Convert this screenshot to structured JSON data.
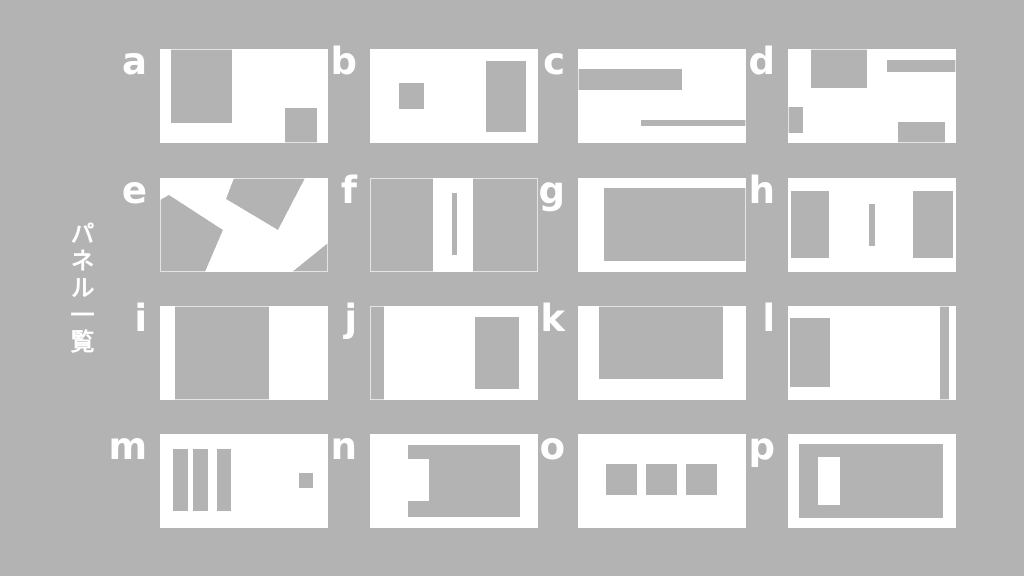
{
  "title": {
    "vertical_label": "パネル一覧"
  },
  "colors": {
    "background": "#b3b3b3",
    "panel": "#ffffff",
    "shape": "#b3b3b3",
    "label_text": "#ffffff"
  },
  "grid": {
    "rows": 4,
    "cols": 4,
    "col_x": [
      160,
      370,
      578,
      788
    ],
    "row_y": [
      49,
      178,
      306,
      434
    ],
    "panel_w": 168,
    "panel_h": 94
  },
  "panels": [
    {
      "label": "a",
      "col": 0,
      "row": 0,
      "shapes": [
        {
          "type": "rect",
          "x": 11,
          "y": 0,
          "w": 61,
          "h": 74
        },
        {
          "type": "rect",
          "x": 125,
          "y": 59,
          "w": 32,
          "h": 35
        }
      ]
    },
    {
      "label": "b",
      "col": 1,
      "row": 0,
      "shapes": [
        {
          "type": "rect",
          "x": 29,
          "y": 34,
          "w": 25,
          "h": 26
        },
        {
          "type": "rect",
          "x": 116,
          "y": 12,
          "w": 40,
          "h": 71
        }
      ]
    },
    {
      "label": "c",
      "col": 2,
      "row": 0,
      "shapes": [
        {
          "type": "rect",
          "x": 0,
          "y": 20,
          "w": 104,
          "h": 21
        },
        {
          "type": "rect",
          "x": 63,
          "y": 71,
          "w": 105,
          "h": 6
        }
      ]
    },
    {
      "label": "d",
      "col": 3,
      "row": 0,
      "shapes": [
        {
          "type": "rect",
          "x": 23,
          "y": 0,
          "w": 56,
          "h": 39
        },
        {
          "type": "rect",
          "x": 99,
          "y": 11,
          "w": 69,
          "h": 12
        },
        {
          "type": "rect",
          "x": 0,
          "y": 58,
          "w": 15,
          "h": 26
        },
        {
          "type": "rect",
          "x": 110,
          "y": 73,
          "w": 47,
          "h": 21
        }
      ]
    },
    {
      "label": "e",
      "col": 0,
      "row": 1,
      "shapes": [
        {
          "type": "polygon",
          "points": [
            [
              74,
              0
            ],
            [
              145,
              0
            ],
            [
              118,
              52
            ],
            [
              66,
              21
            ]
          ]
        },
        {
          "type": "polygon",
          "points": [
            [
              0,
              22
            ],
            [
              9,
              17
            ],
            [
              63,
              52
            ],
            [
              45,
              94
            ],
            [
              0,
              94
            ]
          ]
        },
        {
          "type": "polygon",
          "points": [
            [
              132,
              94
            ],
            [
              168,
              94
            ],
            [
              168,
              65
            ]
          ]
        }
      ]
    },
    {
      "label": "f",
      "col": 1,
      "row": 1,
      "shapes": [
        {
          "type": "rect",
          "x": 0,
          "y": 0,
          "w": 63,
          "h": 94
        },
        {
          "type": "rect",
          "x": 103,
          "y": 0,
          "w": 65,
          "h": 94
        },
        {
          "type": "rect",
          "x": 82,
          "y": 15,
          "w": 5,
          "h": 62
        }
      ]
    },
    {
      "label": "g",
      "col": 2,
      "row": 1,
      "shapes": [
        {
          "type": "rect",
          "x": 26,
          "y": 10,
          "w": 142,
          "h": 73
        }
      ]
    },
    {
      "label": "h",
      "col": 3,
      "row": 1,
      "shapes": [
        {
          "type": "rect",
          "x": 3,
          "y": 13,
          "w": 38,
          "h": 67
        },
        {
          "type": "rect",
          "x": 81,
          "y": 26,
          "w": 6,
          "h": 42
        },
        {
          "type": "rect",
          "x": 125,
          "y": 13,
          "w": 40,
          "h": 67
        }
      ]
    },
    {
      "label": "i",
      "col": 0,
      "row": 2,
      "shapes": [
        {
          "type": "rect",
          "x": 15,
          "y": 0,
          "w": 94,
          "h": 94
        }
      ]
    },
    {
      "label": "j",
      "col": 1,
      "row": 2,
      "shapes": [
        {
          "type": "rect",
          "x": 0,
          "y": 0,
          "w": 14,
          "h": 94
        },
        {
          "type": "rect",
          "x": 105,
          "y": 11,
          "w": 44,
          "h": 72
        }
      ]
    },
    {
      "label": "k",
      "col": 2,
      "row": 2,
      "shapes": [
        {
          "type": "rect",
          "x": 21,
          "y": 0,
          "w": 124,
          "h": 73
        }
      ]
    },
    {
      "label": "l",
      "col": 3,
      "row": 2,
      "shapes": [
        {
          "type": "rect",
          "x": 2,
          "y": 12,
          "w": 40,
          "h": 69
        },
        {
          "type": "rect",
          "x": 152,
          "y": 0,
          "w": 9,
          "h": 94
        }
      ]
    },
    {
      "label": "m",
      "col": 0,
      "row": 3,
      "shapes": [
        {
          "type": "rect",
          "x": 13,
          "y": 15,
          "w": 15,
          "h": 62
        },
        {
          "type": "rect",
          "x": 33,
          "y": 15,
          "w": 15,
          "h": 62
        },
        {
          "type": "rect",
          "x": 57,
          "y": 15,
          "w": 14,
          "h": 62
        },
        {
          "type": "rect",
          "x": 139,
          "y": 39,
          "w": 14,
          "h": 15
        }
      ]
    },
    {
      "label": "n",
      "col": 1,
      "row": 3,
      "shapes": [
        {
          "type": "rect",
          "x": 38,
          "y": 11,
          "w": 112,
          "h": 14
        },
        {
          "type": "rect",
          "x": 59,
          "y": 25,
          "w": 91,
          "h": 42
        },
        {
          "type": "rect",
          "x": 38,
          "y": 67,
          "w": 112,
          "h": 16
        }
      ]
    },
    {
      "label": "o",
      "col": 2,
      "row": 3,
      "shapes": [
        {
          "type": "rect",
          "x": 28,
          "y": 30,
          "w": 31,
          "h": 31
        },
        {
          "type": "rect",
          "x": 68,
          "y": 30,
          "w": 31,
          "h": 31
        },
        {
          "type": "rect",
          "x": 108,
          "y": 30,
          "w": 31,
          "h": 31
        }
      ]
    },
    {
      "label": "p",
      "col": 3,
      "row": 3,
      "shapes": [
        {
          "type": "rect",
          "x": 11,
          "y": 10,
          "w": 144,
          "h": 74
        },
        {
          "type": "rect",
          "x": 30,
          "y": 23,
          "w": 22,
          "h": 48,
          "fill": "panel"
        }
      ]
    }
  ]
}
